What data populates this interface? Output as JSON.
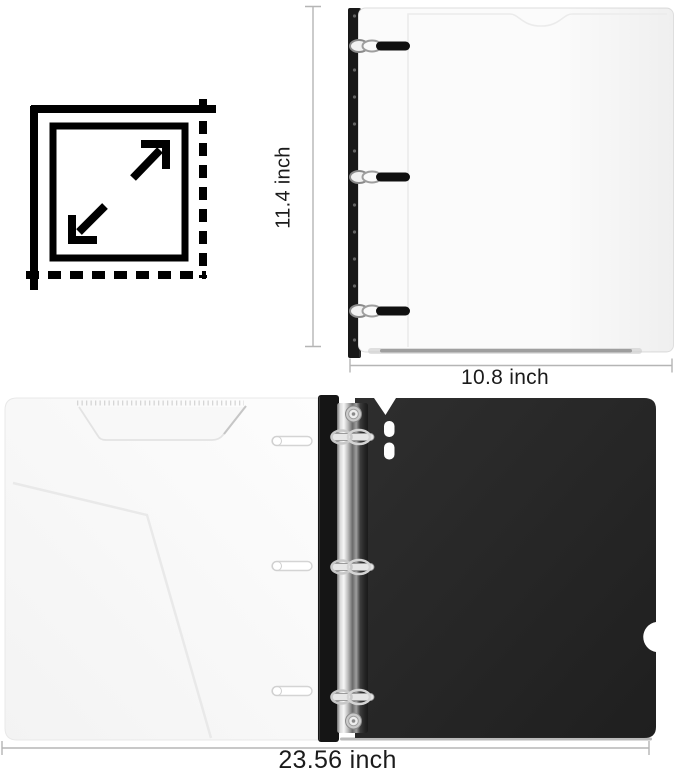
{
  "image_type": "product dimension diagram",
  "labels": {
    "height": "11.4 inch",
    "width": "10.8 inch",
    "open_width": "23.56 inch"
  },
  "icons": [
    {
      "name": "dimensions-icon",
      "description": "dashed/solid square with expand arrows indicating measured size"
    }
  ],
  "objects": [
    {
      "name": "closed-binder",
      "description": "closed binder front view: white cover, black punched spine, three chrome ring clips"
    },
    {
      "name": "open-binder",
      "description": "open binder inside view: white pocket panel left, black cover right, chrome 3-ring mechanism on spine"
    }
  ],
  "colors": {
    "background": "#ffffff",
    "measure_line": "#b5b5b5",
    "label_text": "#1b1b1b",
    "icon": "#000000",
    "binder_white": "#fbfbfb",
    "binder_black": "#242424",
    "spine_black": "#161616",
    "ring_silver": "#d9d9d9"
  }
}
